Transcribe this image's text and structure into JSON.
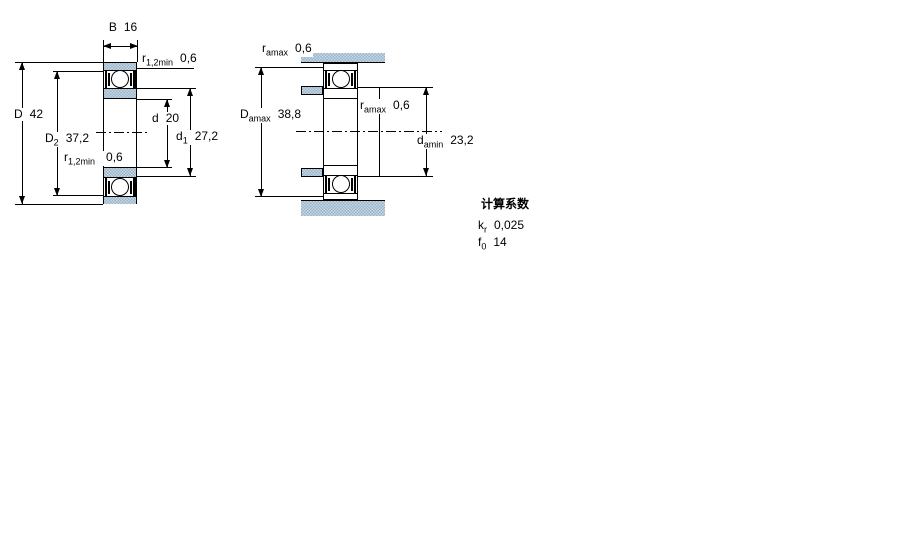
{
  "figure1": {
    "name": "bearing cross-section with boundary dimensions",
    "labels": {
      "width": {
        "base": "B",
        "value": "16"
      },
      "r_top": {
        "base": "r",
        "sub": "1,2min",
        "value": "0,6"
      },
      "outer_diameter": {
        "base": "D",
        "value": "42"
      },
      "d2": {
        "base": "D",
        "sub": "2",
        "value": "37,2"
      },
      "bore": {
        "base": "d",
        "value": "20"
      },
      "d1": {
        "base": "d",
        "sub": "1",
        "value": "27,2"
      },
      "r_bottom": {
        "base": "r",
        "sub": "1,2min",
        "value": "0,6"
      }
    }
  },
  "figure2": {
    "name": "bearing mounting / abutment dimensions",
    "labels": {
      "r_top": {
        "base": "r",
        "sub": "amax",
        "value": "0,6"
      },
      "da_max": {
        "base": "D",
        "sub": "amax",
        "value": "38,8"
      },
      "r_mid": {
        "base": "r",
        "sub": "amax",
        "value": "0,6"
      },
      "da_min": {
        "base": "d",
        "sub": "amin",
        "value": "23,2"
      }
    }
  },
  "factors": {
    "title": "计算系数",
    "rows": [
      {
        "base": "k",
        "sub": "r",
        "value": "0,025"
      },
      {
        "base": "f",
        "sub": "0",
        "value": "14"
      }
    ]
  },
  "colors": {
    "hatch_blue": "#92b6d2",
    "hatch_base": "#cdd6da",
    "line": "#000000"
  }
}
